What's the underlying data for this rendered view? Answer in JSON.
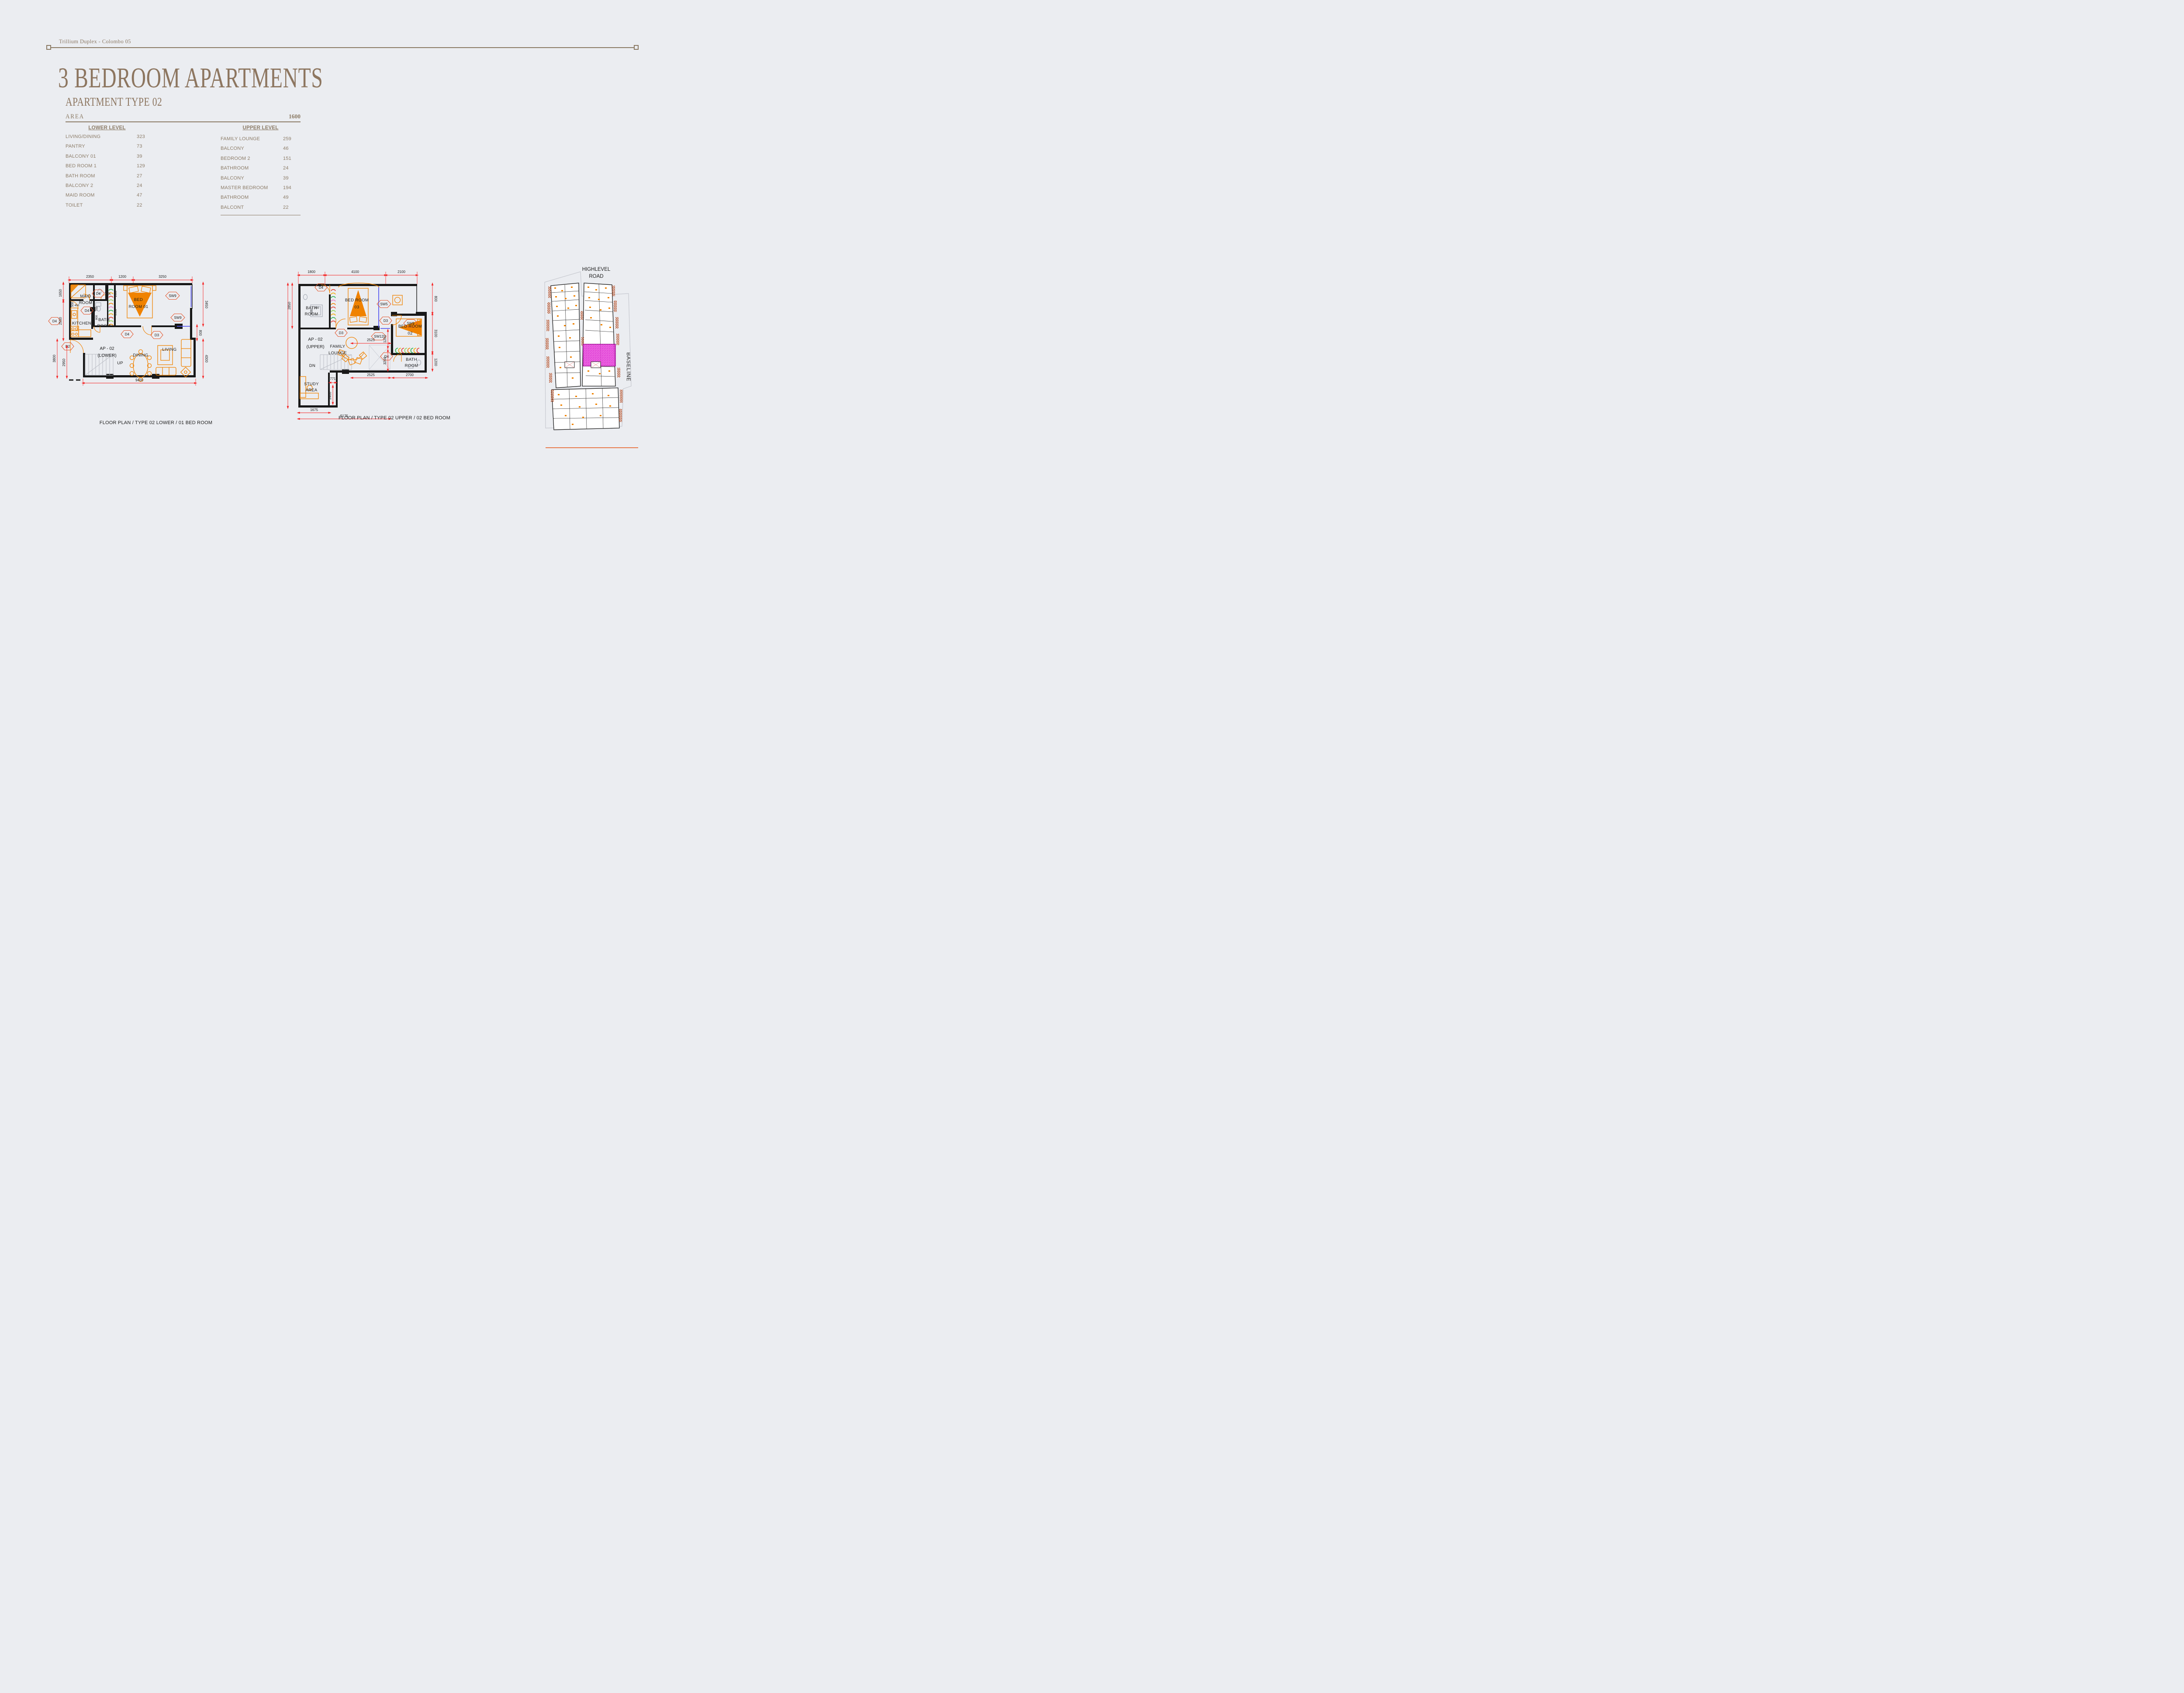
{
  "header": {
    "project": "Trillium Duplex - Colombo 05"
  },
  "title": "3 BEDROOM APARTMENTS",
  "subtitle": "APARTMENT TYPE  02",
  "area": {
    "label": "AREA",
    "total": "1600"
  },
  "table": {
    "lower": {
      "heading": "LOWER LEVEL",
      "rows": [
        [
          "LIVING/DINING",
          "323"
        ],
        [
          "PANTRY",
          "73"
        ],
        [
          "BALCONY 01",
          "39"
        ],
        [
          "BED ROOM 1",
          "129"
        ],
        [
          "BATH ROOM",
          "27"
        ],
        [
          "BALCONY 2",
          "24"
        ],
        [
          "MAID ROOM",
          "47"
        ],
        [
          "TOILET",
          "22"
        ]
      ]
    },
    "upper": {
      "heading": "UPPER LEVEL",
      "rows": [
        [
          "FAMILY LOUNGE",
          "259"
        ],
        [
          "BALCONY",
          "46"
        ],
        [
          "BEDROOM 2",
          "151"
        ],
        [
          "BATHROOM",
          "24"
        ],
        [
          "BALCONY",
          "39"
        ],
        [
          "MASTER BEDROOM",
          "194"
        ],
        [
          "BATHROOM",
          "49"
        ],
        [
          "BALCONT",
          "22"
        ]
      ]
    }
  },
  "lower_plan": {
    "caption": "FLOOR  PLAN / TYPE 02 LOWER / 01 BED ROOM",
    "unit": "AP - 02",
    "unit_level": "(LOWER)",
    "rooms": {
      "maid1": "MAID",
      "maid2": "ROOM",
      "toi": "TOI.",
      "bath1": "BATH",
      "bath2": "ROOM",
      "kitchen": "KITCHEN",
      "bed1": "BED",
      "bed2": "ROOM 01",
      "dining": "DINING",
      "living": "LIVING",
      "up": "UP"
    },
    "tags": {
      "d4a": "D4",
      "d4b": "D4",
      "d4c": "D4",
      "d4d": "D4",
      "d2": "D2",
      "d3": "D3",
      "sw9a": "SW9",
      "sw9b": "SW9"
    },
    "dims": {
      "top": [
        "2350",
        "1200",
        "3250"
      ],
      "left": [
        "1650",
        "2550",
        "3800",
        "2950"
      ],
      "right": [
        "3450",
        "800",
        "4300"
      ],
      "bottom": "9400",
      "inner": [
        "1000",
        "2350",
        "700",
        "800",
        "500",
        "450"
      ]
    }
  },
  "upper_plan": {
    "caption": "FLOOR  PLAN / TYPE 02 UPPER / 02 BED ROOM",
    "unit": "AP - 02",
    "unit_level": "(UPPER)",
    "rooms": {
      "bathA1": "BATH",
      "bathA2": "ROOM",
      "bed31": "BED ROOM",
      "bed32": "03",
      "family1": "FAMILY",
      "family2": "LOUNGE",
      "bed21": "BED ROOM",
      "bed22": "02",
      "bathB1": "BATH",
      "bathB2": "ROOM",
      "study1": "STUDY",
      "study2": "AREA",
      "dn": "DN"
    },
    "tags": {
      "d4a": "D4",
      "d4b": "D4",
      "d3a": "D3",
      "d3b": "D3",
      "sw5": "SW5",
      "sw9": "SW9",
      "sw12": "SW12"
    },
    "dims": {
      "top": [
        "1800",
        "4100",
        "2100"
      ],
      "left": [
        "2850",
        "7000"
      ],
      "right": [
        "800",
        "3100",
        "1200"
      ],
      "inner": [
        "2525",
        "1200",
        "3200",
        "500",
        "700"
      ],
      "bottom": [
        "2525",
        "2700",
        "771",
        "2400",
        "1675",
        "5175"
      ]
    }
  },
  "site_plan": {
    "road1": "HIGHLEVEL",
    "road2": "ROAD",
    "baseline": "BASELINE"
  },
  "colors": {
    "accent_brown": "#8d7660",
    "wall_black": "#181818",
    "furniture_orange": "#f08200",
    "dim_red": "#f52222",
    "window_blue": "#5a5af0",
    "highlight_magenta": "#ef5fe3",
    "brick": "#b44d24",
    "footer_orange": "#e87b4b",
    "background": "#ebedf1"
  }
}
